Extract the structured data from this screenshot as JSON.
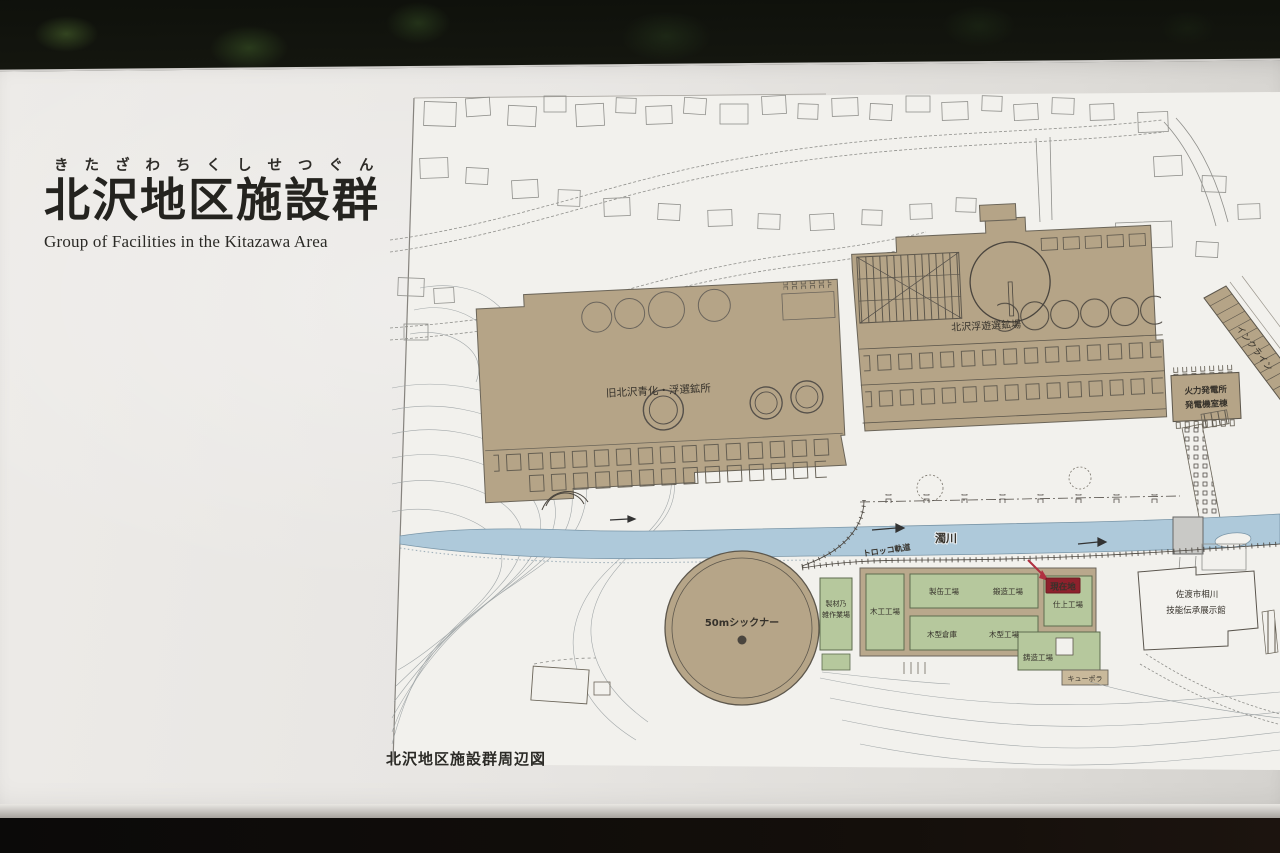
{
  "sign": {
    "furigana": "きたざわちくしせつぐん",
    "title": "北沢地区施設群",
    "subtitle_en": "Group of Facilities in the Kitazawa Area",
    "map_caption": "北沢地区施設群周辺図"
  },
  "map": {
    "labels": {
      "former_cyanide_flotation_mill": "旧北沢青化・浮選鉱所",
      "flotation_plant": "北沢浮遊選鉱場",
      "thermal_power_plant_l1": "火力発電所",
      "thermal_power_plant_l2": "発電機室棟",
      "incline": "インクライン",
      "river": "濁川",
      "minecart_track": "トロッコ軌道",
      "thickener": "50mシックナー",
      "sawmill_l1": "製材乃",
      "sawmill_l2": "雑作業場",
      "woodworking_shop": "木工工場",
      "can_making_shop": "製缶工場",
      "forging_shop": "鍛造工場",
      "you_are_here": "現在地",
      "finishing_shop": "仕上工場",
      "pattern_warehouse": "木型倉庫",
      "pattern_shop": "木型工場",
      "casting_shop": "鋳造工場",
      "cupola": "キューポラ",
      "exhibition_hall_l1": "佐渡市相川",
      "exhibition_hall_l2": "技能伝承展示館"
    },
    "colors": {
      "building_tan": "#b5a487",
      "river_blue": "#aec9da",
      "green_area": "#b6c89d",
      "you_are_here_red": "#8e212c",
      "paper": "#f2f1ed"
    }
  }
}
